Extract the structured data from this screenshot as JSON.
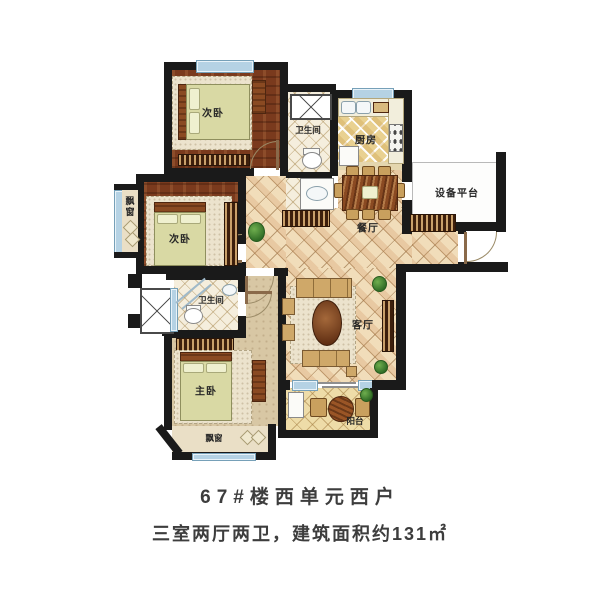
{
  "caption": {
    "line1": "67#楼西单元西户",
    "line2": "三室两厅两卫，建筑面积约131㎡"
  },
  "labels": {
    "bedroom_top": "次卧",
    "bedroom_mid": "次卧",
    "master": "主卧",
    "bath_top": "卫生间",
    "bath_mid": "卫生间",
    "kitchen": "厨房",
    "dining": "餐厅",
    "living": "客厅",
    "balcony": "阳台",
    "equipment": "设备平台",
    "bay_left": "飘窗",
    "bay_bottom": "飘窗"
  },
  "colors": {
    "wall": "#1a1a1a",
    "window": "#b5d2e4",
    "wood_floor": "#7a3a1d",
    "main_tile": "#f1ddba",
    "kitchen_tile": "#e9d191",
    "bed": "#d9d9a4",
    "text": "#3d3d3d"
  }
}
